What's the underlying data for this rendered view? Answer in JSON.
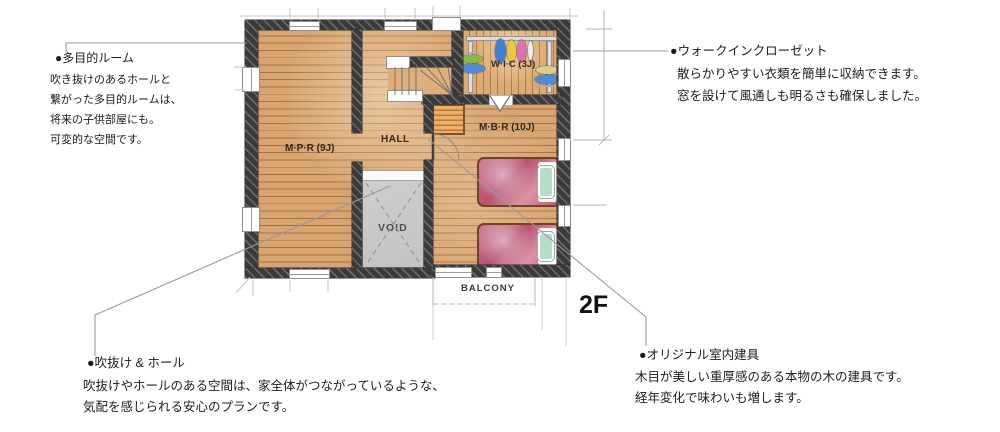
{
  "floor_label": "2F",
  "rooms": {
    "mpr": "M·P·R (9J)",
    "hall": "HALL",
    "wic": "W·I·C (3J)",
    "mbr": "M·B·R (10J)",
    "void": "VOID",
    "balcony": "BALCONY"
  },
  "notes": {
    "multipurpose": {
      "bullet": "●",
      "title": "多目的ルーム",
      "lines": [
        "吹き抜けのあるホールと",
        "繋がった多目的ルームは、",
        "将来の子供部屋にも。",
        "可変的な空間です。"
      ]
    },
    "walk_in_closet": {
      "bullet": "●",
      "title": "ウォークインクローゼット",
      "lines": [
        "散らかりやすい衣類を簡単に収納できます。",
        "窓を設けて風通しも明るさも確保しました。"
      ]
    },
    "void_hall": {
      "bullet": "●",
      "title": "吹抜け & ホール",
      "lines": [
        "吹抜けやホールのある空間は、家全体がつながっているような、",
        "気配を感じられる安心のプランです。"
      ]
    },
    "interior_door": {
      "bullet": "●",
      "title": "オリジナル室内建具",
      "lines": [
        "木目が美しい重厚感のある本物の木の建具です。",
        "経年変化で味わいも増します。"
      ]
    }
  },
  "colors": {
    "floor_wood": "#d8a470",
    "floor_line": "#6e4016",
    "wall_dark": "#3a3a3a",
    "void_gray": "#c9c9c9",
    "bed_cover_pink": "#c05a78",
    "bed_pillow_mint": "#b7ddc8",
    "storage_orange": "#e2953f",
    "leader_line": "#9a9a9a",
    "clothes_blue": "#3f7fd0",
    "clothes_yellow": "#e6c93e",
    "clothes_pink": "#e070b0",
    "clothes_green": "#8abc42",
    "clothes_light_blue": "#4d8cd8",
    "clothes_beige": "#d8cf8e"
  }
}
